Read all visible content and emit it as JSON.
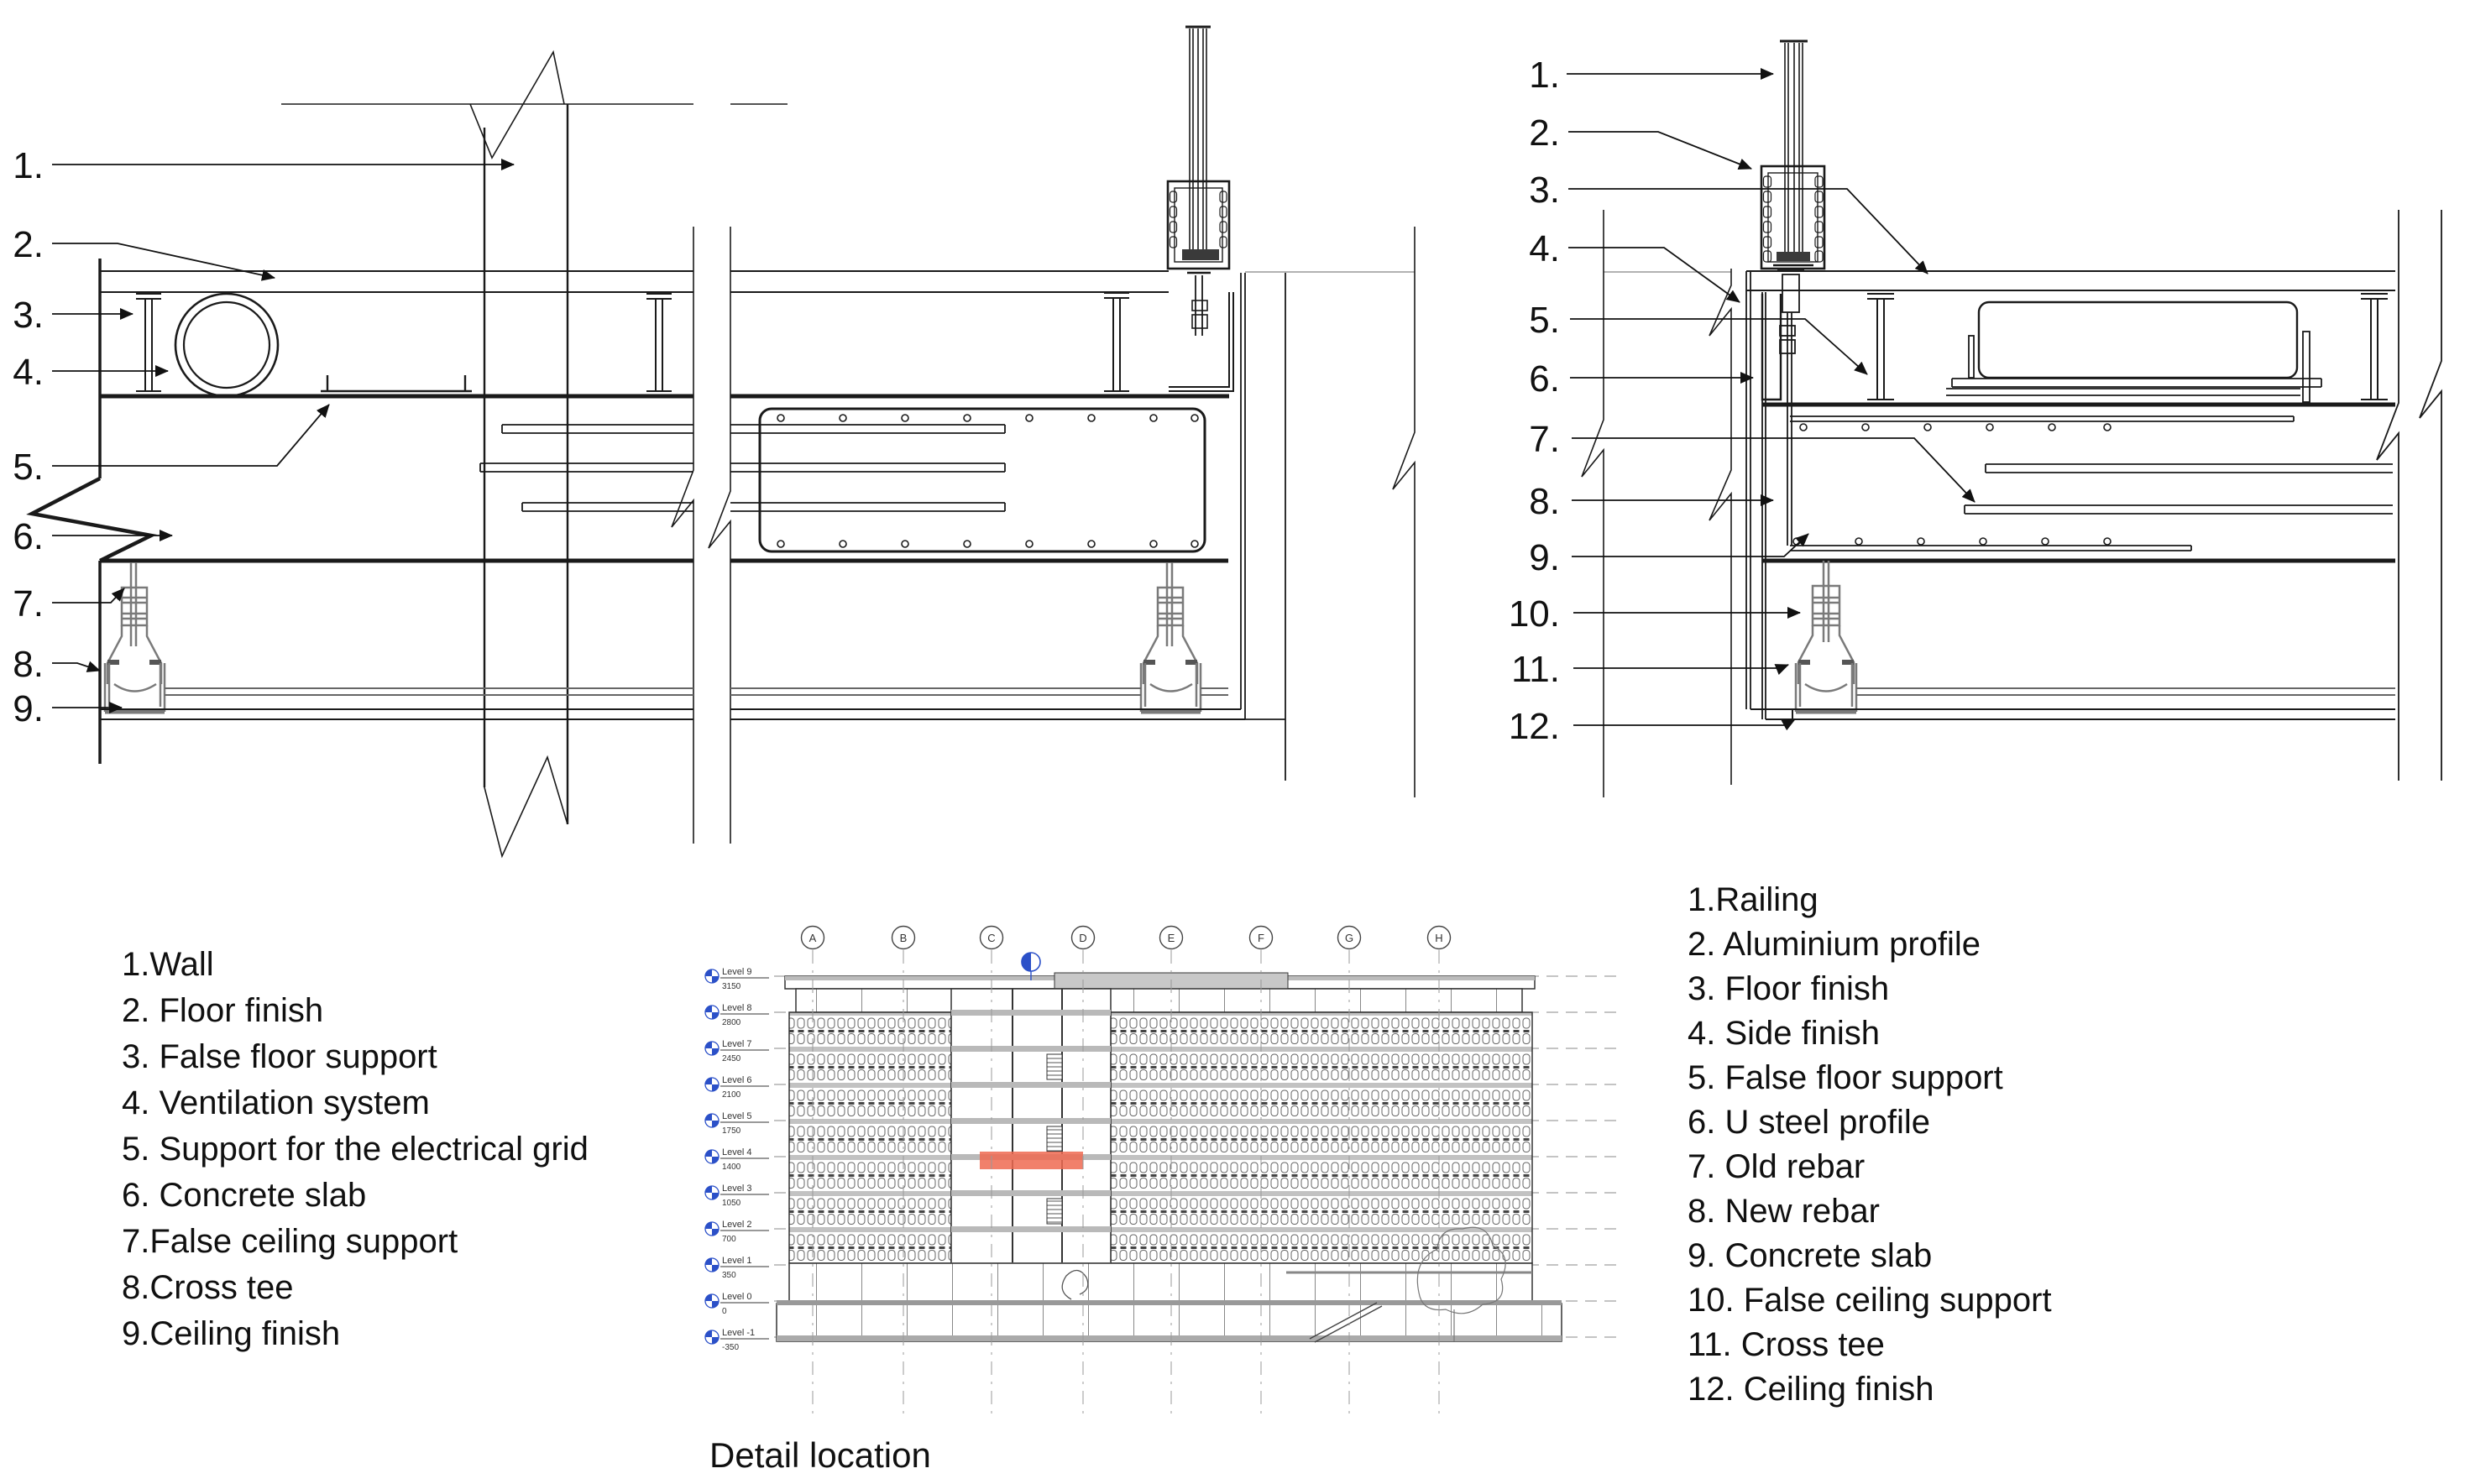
{
  "left_detail": {
    "callouts": [
      "1.",
      "2.",
      "3.",
      "4.",
      "5.",
      "6.",
      "7.",
      "8.",
      "9."
    ]
  },
  "right_detail": {
    "callouts": [
      "1.",
      "2.",
      "3.",
      "4.",
      "5.",
      "6.",
      "7.",
      "8.",
      "9.",
      "10.",
      "11.",
      "12."
    ]
  },
  "legend_left": {
    "items": [
      "1.Wall",
      "2. Floor finish",
      "3. False floor support",
      "4. Ventilation system",
      "5. Support for the electrical grid",
      "6. Concrete slab",
      "7.False ceiling support",
      "8.Cross tee",
      "9.Ceiling finish"
    ]
  },
  "legend_right": {
    "items": [
      "1.Railing",
      "2. Aluminium profile",
      "3. Floor finish",
      "4. Side finish",
      "5. False floor support",
      "6. U steel profile",
      "7. Old rebar",
      "8. New rebar",
      "9. Concrete slab",
      "10. False ceiling support",
      "11. Cross tee",
      "12. Ceiling finish"
    ]
  },
  "elevation": {
    "caption": "Detail location",
    "grid_letters": [
      "A",
      "B",
      "C",
      "D",
      "E",
      "F",
      "G",
      "H"
    ],
    "levels": [
      {
        "name": "Level 9",
        "elevation": "3150"
      },
      {
        "name": "Level 8",
        "elevation": "2800"
      },
      {
        "name": "Level 7",
        "elevation": "2450"
      },
      {
        "name": "Level 6",
        "elevation": "2100"
      },
      {
        "name": "Level 5",
        "elevation": "1750"
      },
      {
        "name": "Level 4",
        "elevation": "1400"
      },
      {
        "name": "Level 3",
        "elevation": "1050"
      },
      {
        "name": "Level 2",
        "elevation": "700"
      },
      {
        "name": "Level 1",
        "elevation": "350"
      },
      {
        "name": "Level 0",
        "elevation": "0"
      },
      {
        "name": "Level -1",
        "elevation": "-350"
      }
    ],
    "highlight_color": "#ee6a51",
    "datum_blue": "#2b50c8"
  }
}
